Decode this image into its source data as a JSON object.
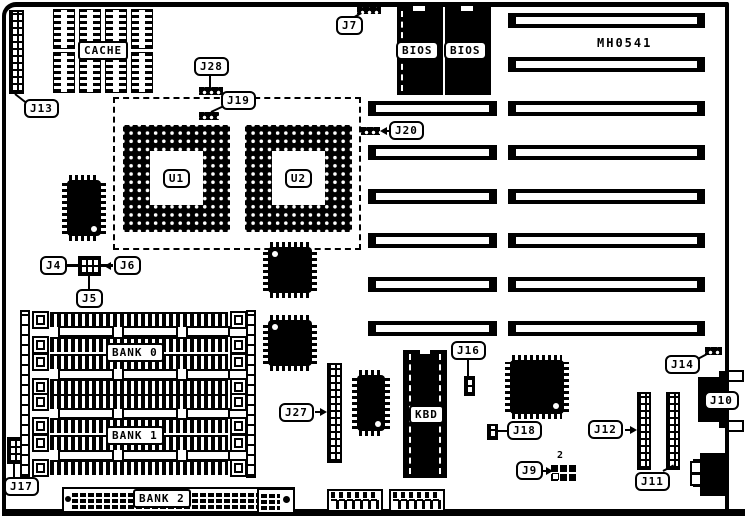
{
  "board_id": "MH0541",
  "chips": {
    "u1": "U1",
    "u2": "U2",
    "cache": "CACHE",
    "bios": "BIOS",
    "kbd": "KBD"
  },
  "memory_banks": {
    "bank0": "BANK 0",
    "bank1": "BANK 1",
    "bank2": "BANK 2"
  },
  "jumpers": {
    "j4": "J4",
    "j5": "J5",
    "j6": "J6",
    "j7": "J7",
    "j9": "J9",
    "j10": "J10",
    "j11": "J11",
    "j12": "J12",
    "j13": "J13",
    "j14": "J14",
    "j16": "J16",
    "j17": "J17",
    "j18": "J18",
    "j19": "J19",
    "j20": "J20",
    "j27": "J27",
    "j28": "J28"
  },
  "annotations": {
    "j9_pin2": "2"
  }
}
